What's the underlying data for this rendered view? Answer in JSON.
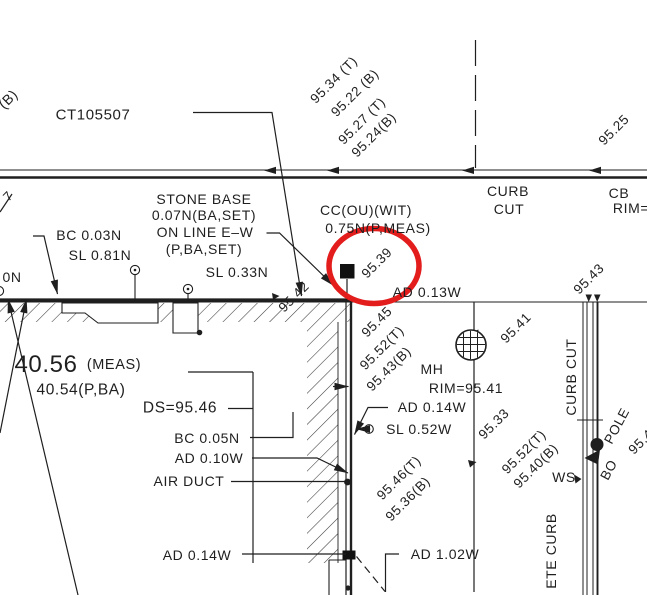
{
  "document": {
    "type": "survey-site-plan"
  },
  "ink_color": "#1f1f1f",
  "background_color": "#ffffff",
  "highlight": {
    "color": "#e31c1c",
    "shape": "ellipse",
    "around": "95.39"
  },
  "labels": [
    {
      "name": "label-b-fragment",
      "text": "(B)",
      "x": 8,
      "y": 99,
      "rot": -45,
      "size": 14
    },
    {
      "name": "label-ct-number",
      "text": "CT105507",
      "x": 93,
      "y": 115,
      "size": 15
    },
    {
      "name": "label-95-34-t",
      "text": "95.34 (T)",
      "x": 334,
      "y": 80,
      "rot": -45,
      "size": 13.5
    },
    {
      "name": "label-95-22-b",
      "text": "95.22 (B)",
      "x": 355,
      "y": 93,
      "rot": -45,
      "size": 13.5
    },
    {
      "name": "label-95-27-t",
      "text": "95.27 (T)",
      "x": 362,
      "y": 121,
      "rot": -45,
      "size": 13.5
    },
    {
      "name": "label-95-24-b",
      "text": "95.24(B)",
      "x": 374,
      "y": 135,
      "rot": -45,
      "size": 13.5
    },
    {
      "name": "label-95-25",
      "text": "95.25",
      "x": 614,
      "y": 130,
      "rot": -45,
      "size": 13.5
    },
    {
      "name": "label-curb-cut-top-line1",
      "text": "CURB",
      "x": 508,
      "y": 191,
      "size": 14
    },
    {
      "name": "label-curb-cut-top-line2",
      "text": "CUT",
      "x": 509,
      "y": 209,
      "size": 14
    },
    {
      "name": "label-cb",
      "text": "CB",
      "x": 619,
      "y": 193,
      "size": 14
    },
    {
      "name": "label-cb-rim",
      "text": "RIM=",
      "x": 631,
      "y": 208,
      "size": 14
    },
    {
      "name": "label-edge-fragment",
      "text": "7",
      "x": 8,
      "y": 196,
      "rot": -45,
      "size": 13
    },
    {
      "name": "label-stone-base-line1",
      "text": "STONE BASE",
      "x": 204,
      "y": 199,
      "size": 14
    },
    {
      "name": "label-stone-base-line2",
      "text": "0.07N(BA,SET)",
      "x": 204,
      "y": 215,
      "size": 14
    },
    {
      "name": "label-stone-base-line3",
      "text": "ON LINE E–W",
      "x": 205,
      "y": 232,
      "size": 14
    },
    {
      "name": "label-stone-base-line4",
      "text": "(P,BA,SET)",
      "x": 204,
      "y": 249,
      "size": 14
    },
    {
      "name": "label-bc-003n",
      "text": "BC 0.03N",
      "x": 89,
      "y": 235,
      "size": 14
    },
    {
      "name": "label-sl-081n",
      "text": "SL 0.81N",
      "x": 100,
      "y": 255,
      "size": 14
    },
    {
      "name": "label-0n",
      "text": "0N",
      "x": 12,
      "y": 277,
      "size": 14
    },
    {
      "name": "label-sl-033n",
      "text": "SL 0.33N",
      "x": 237,
      "y": 272,
      "size": 14
    },
    {
      "name": "label-cc-ou-wit",
      "text": "CC(OU)(WIT)",
      "x": 366,
      "y": 210,
      "size": 14
    },
    {
      "name": "label-075n-p-meas",
      "text": "0.75N(P,MEAS)",
      "x": 378,
      "y": 228,
      "size": 14
    },
    {
      "name": "label-95-39",
      "text": "95.39",
      "x": 377,
      "y": 263,
      "rot": -45,
      "size": 13.5
    },
    {
      "name": "label-95-42",
      "text": "95.42",
      "x": 294,
      "y": 297,
      "rot": -45,
      "size": 13.5
    },
    {
      "name": "label-ad-013w",
      "text": "AD 0.13W",
      "x": 427,
      "y": 292,
      "size": 14
    },
    {
      "name": "label-95-41-street",
      "text": "95.41",
      "x": 516,
      "y": 328,
      "rot": -45,
      "size": 13.5
    },
    {
      "name": "label-95-43-curb",
      "text": "95.43",
      "x": 589,
      "y": 279,
      "rot": -45,
      "size": 13.5
    },
    {
      "name": "label-95-45",
      "text": "95.45",
      "x": 377,
      "y": 322,
      "rot": -45,
      "size": 13.5
    },
    {
      "name": "label-95-52t",
      "text": "95.52(T)",
      "x": 382,
      "y": 348,
      "rot": -45,
      "size": 13.5
    },
    {
      "name": "label-95-43b",
      "text": "95.43(B)",
      "x": 389,
      "y": 369,
      "rot": -45,
      "size": 13.5
    },
    {
      "name": "label-mh",
      "text": "MH",
      "x": 432,
      "y": 369,
      "size": 14
    },
    {
      "name": "label-mh-rim",
      "text": "RIM=95.41",
      "x": 466,
      "y": 388,
      "size": 14
    },
    {
      "name": "label-40-56",
      "text": "40.56",
      "x": 46,
      "y": 365,
      "size": 24
    },
    {
      "name": "label-40-56-meas",
      "text": "(MEAS)",
      "x": 114,
      "y": 365,
      "size": 14.5
    },
    {
      "name": "label-40-54",
      "text": "40.54(P,BA)",
      "x": 81,
      "y": 390,
      "size": 15.5
    },
    {
      "name": "label-ds-9546",
      "text": "DS=95.46",
      "x": 180,
      "y": 408,
      "size": 15.5
    },
    {
      "name": "label-ad-014w-mid",
      "text": "AD 0.14W",
      "x": 432,
      "y": 407,
      "size": 14
    },
    {
      "name": "label-sl-052w",
      "text": "SL 0.52W",
      "x": 419,
      "y": 429,
      "size": 14
    },
    {
      "name": "label-95-33",
      "text": "95.33",
      "x": 494,
      "y": 424,
      "rot": -45,
      "size": 13.5
    },
    {
      "name": "label-bc-005n",
      "text": "BC 0.05N",
      "x": 207,
      "y": 438,
      "size": 14
    },
    {
      "name": "label-ad-010w",
      "text": "AD 0.10W",
      "x": 209,
      "y": 458,
      "size": 14
    },
    {
      "name": "label-air-duct",
      "text": "AIR DUCT",
      "x": 189,
      "y": 481,
      "size": 14
    },
    {
      "name": "label-95-46t",
      "text": "95.46(T)",
      "x": 399,
      "y": 478,
      "rot": -45,
      "size": 13.5
    },
    {
      "name": "label-95-36b",
      "text": "95.36(B)",
      "x": 408,
      "y": 499,
      "rot": -45,
      "size": 13.5
    },
    {
      "name": "label-95-52t-2",
      "text": "95.52(T)",
      "x": 524,
      "y": 452,
      "rot": -45,
      "size": 13.5
    },
    {
      "name": "label-95-40b-2",
      "text": "95.40(B)",
      "x": 536,
      "y": 466,
      "rot": -45,
      "size": 13.5
    },
    {
      "name": "label-ws",
      "text": "WS",
      "x": 564,
      "y": 477,
      "size": 14
    },
    {
      "name": "label-pole",
      "text": "POLE",
      "x": 617,
      "y": 426,
      "rot": -62,
      "size": 13.5
    },
    {
      "name": "label-bo",
      "text": "BO",
      "x": 609,
      "y": 470,
      "rot": -62,
      "size": 13.5
    },
    {
      "name": "label-95-4-edge",
      "text": "95.4",
      "x": 641,
      "y": 442,
      "rot": -45,
      "size": 13.5
    },
    {
      "name": "label-curb-cut-vertical",
      "text": "CURB CUT",
      "x": 571,
      "y": 377,
      "rot": -90,
      "size": 14
    },
    {
      "name": "label-ete-curb-vertical",
      "text": "ETE CURB",
      "x": 551,
      "y": 551,
      "rot": -90,
      "size": 14
    },
    {
      "name": "label-ad-014w-bottom",
      "text": "AD 0.14W",
      "x": 197,
      "y": 555,
      "size": 14
    },
    {
      "name": "label-ad-102w",
      "text": "AD 1.02W",
      "x": 445,
      "y": 554,
      "size": 14
    }
  ]
}
